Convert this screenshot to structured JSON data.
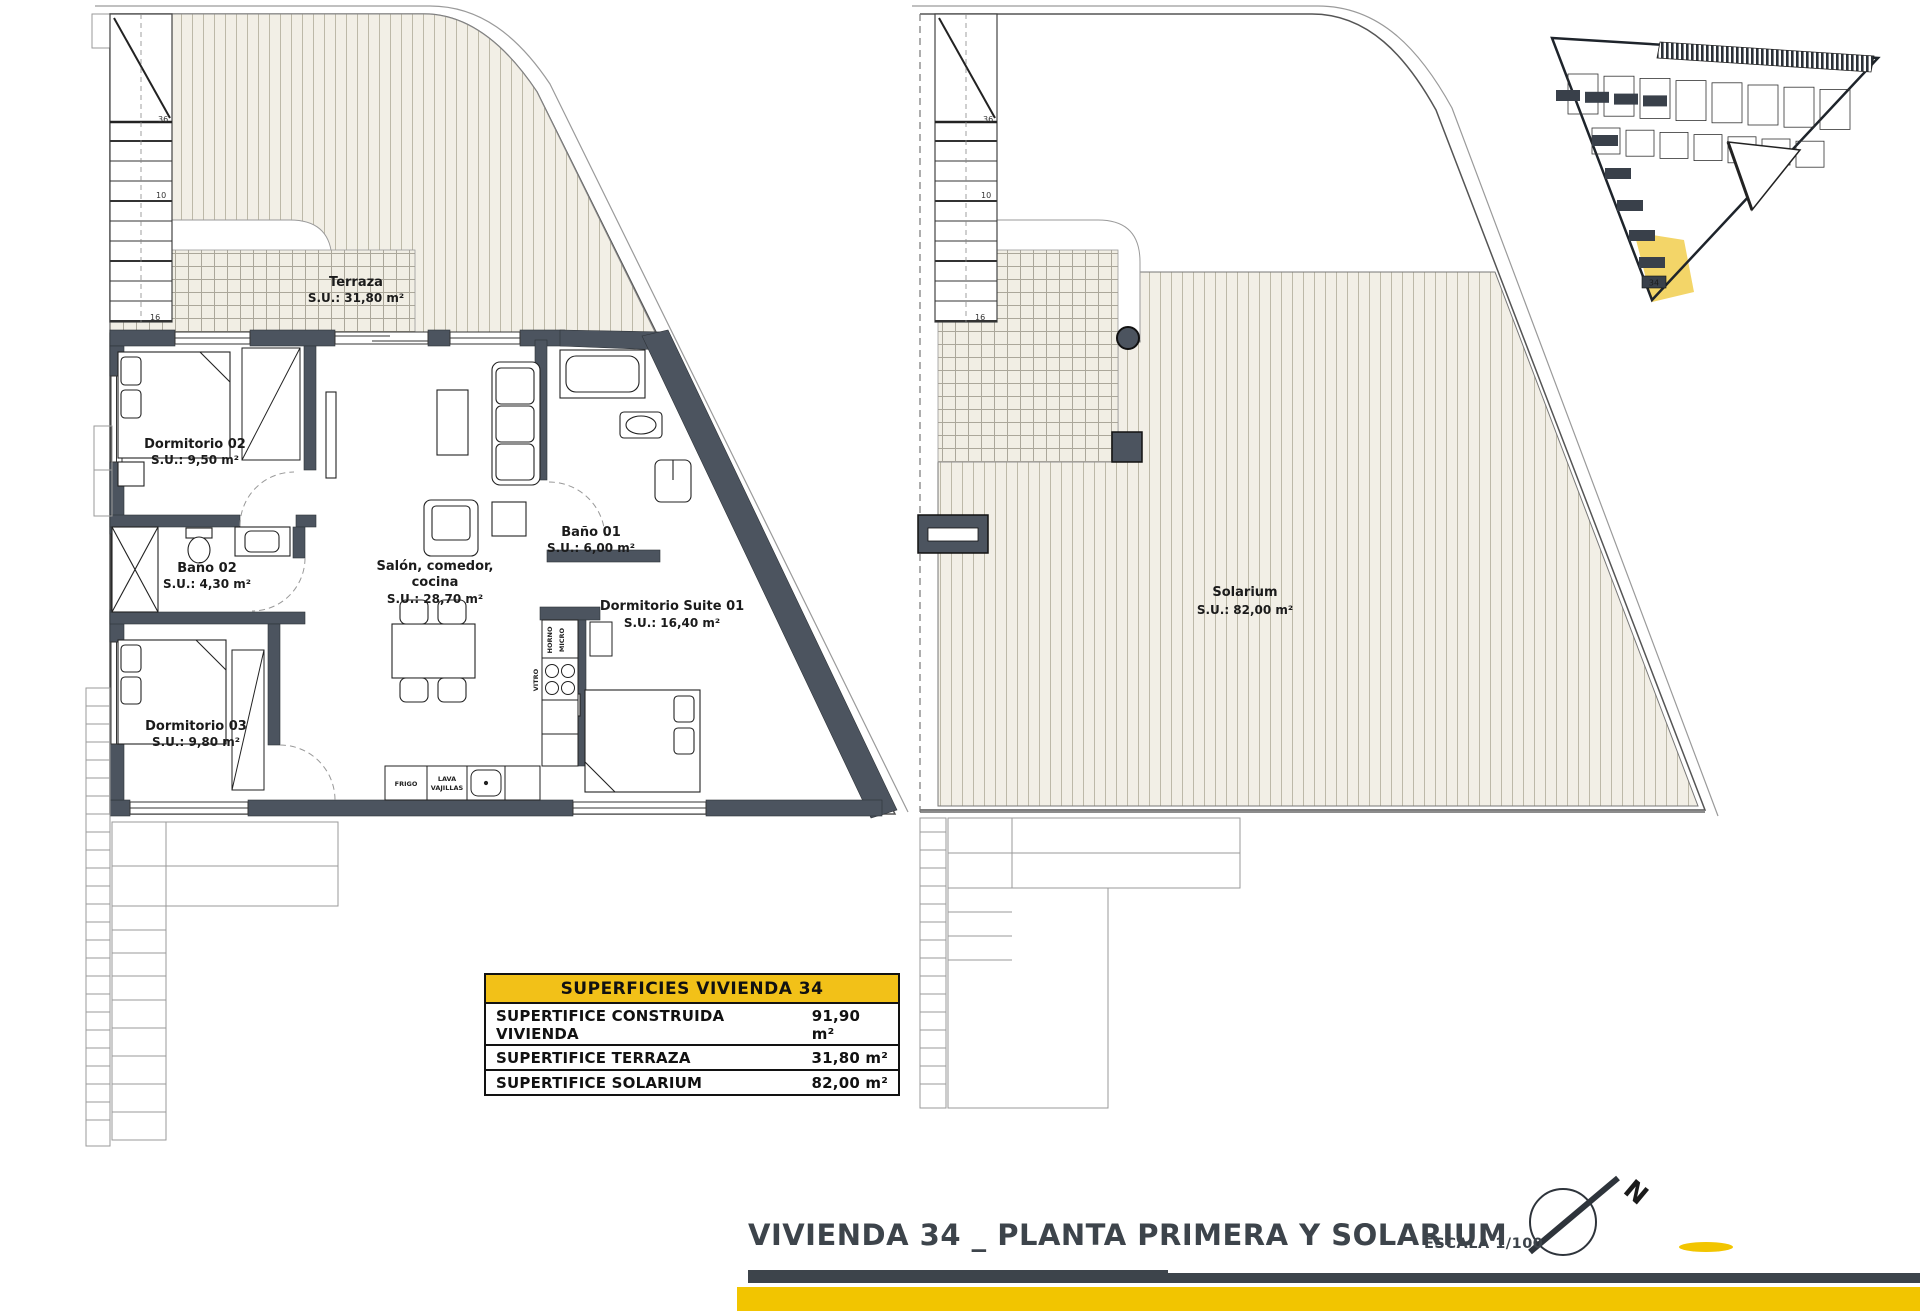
{
  "document": {
    "title": "VIVIENDA 34 _ PLANTA PRIMERA Y SOLARIUM",
    "scale": "ESCALA 1/100"
  },
  "areas_table": {
    "header": "SUPERFICIES VIVIENDA 34",
    "rows": [
      {
        "label": "SUPERTIFICE CONSTRUIDA VIVIENDA",
        "value": "91,90 m²"
      },
      {
        "label": "SUPERTIFICE TERRAZA",
        "value": "31,80 m²"
      },
      {
        "label": "SUPERTIFICE SOLARIUM",
        "value": "82,00 m²"
      }
    ]
  },
  "first_floor": {
    "rooms": [
      {
        "name": "Terraza",
        "area": "S.U.: 31,80 m²"
      },
      {
        "name": "Dormitorio 02",
        "area": "S.U.: 9,50 m²"
      },
      {
        "name": "Baño 01",
        "area": "S.U.: 6,00 m²"
      },
      {
        "name": "Salón, comedor,",
        "name2": "cocina",
        "area": "S.U.: 28,70 m²"
      },
      {
        "name": "Baño 02",
        "area": "S.U.: 4,30 m²"
      },
      {
        "name": "Dormitorio Suite 01",
        "area": "S.U.: 16,40 m²"
      },
      {
        "name": "Dormitorio 03",
        "area": "S.U.: 9,80 m²"
      }
    ],
    "kitchen": {
      "fridge": "FRIGO",
      "dishwasher_line1": "LAVA",
      "dishwasher_line2": "VAJILLAS",
      "oven_line1": "HORNO",
      "oven_line2": "MICRO",
      "hob": "VITRO"
    },
    "terrace_fixtures": {
      "laundry": "LAV",
      "cabinet": "MUEB"
    },
    "stair_marks": {
      "upper": "36",
      "lower": "10",
      "base": "16"
    }
  },
  "solarium_floor": {
    "room": {
      "name": "Solarium",
      "area": "S.U.: 82,00 m²"
    },
    "stair_marks": {
      "upper": "36",
      "lower": "10",
      "base": "16"
    }
  },
  "site_plan": {
    "highlighted_unit": "34",
    "highlight_color": "#F3D568"
  },
  "colors": {
    "accent_yellow": "#F2C118",
    "bar_yellow": "#F2C500",
    "wall": "#4C545F",
    "title_text": "#3D444B"
  }
}
